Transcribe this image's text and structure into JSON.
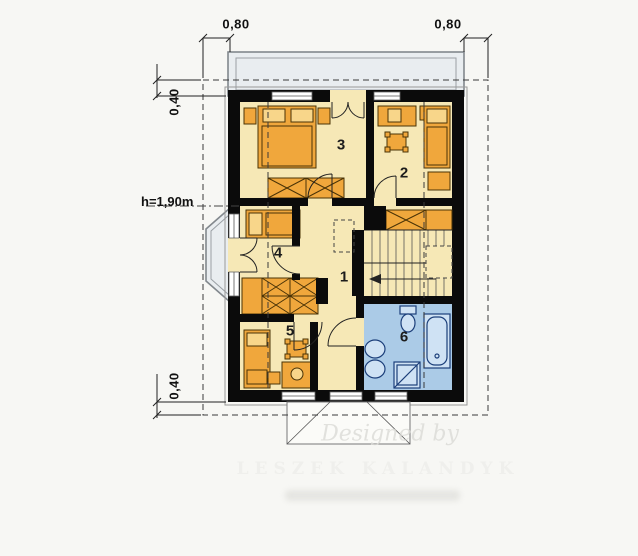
{
  "floor_plan": {
    "room_labels": [
      {
        "id": "hall-landing",
        "number": "1"
      },
      {
        "id": "bedroom-top-right",
        "number": "2"
      },
      {
        "id": "bedroom-top-left",
        "number": "3"
      },
      {
        "id": "bedroom-middle-left",
        "number": "4"
      },
      {
        "id": "bedroom-bottom-left",
        "number": "5"
      },
      {
        "id": "bathroom",
        "number": "6"
      }
    ],
    "dimensions": {
      "overhang_top_left": "0,80",
      "overhang_top_right": "0,80",
      "overhang_side_top": "0,40",
      "overhang_side_bottom": "0,40",
      "knee_wall_height": "h=1,90m"
    },
    "watermark": {
      "line1": "Designed by",
      "line2": "LESZEK KALANDYK"
    },
    "colors": {
      "wall": "#0b0b0b",
      "floor": "#f6e8b6",
      "furniture": "#f0a73c",
      "bathroom_floor": "#abcbe7",
      "fixtures": "#cfe2f4",
      "balcony": "#e9edf0",
      "background": "#f7f7f4"
    }
  }
}
